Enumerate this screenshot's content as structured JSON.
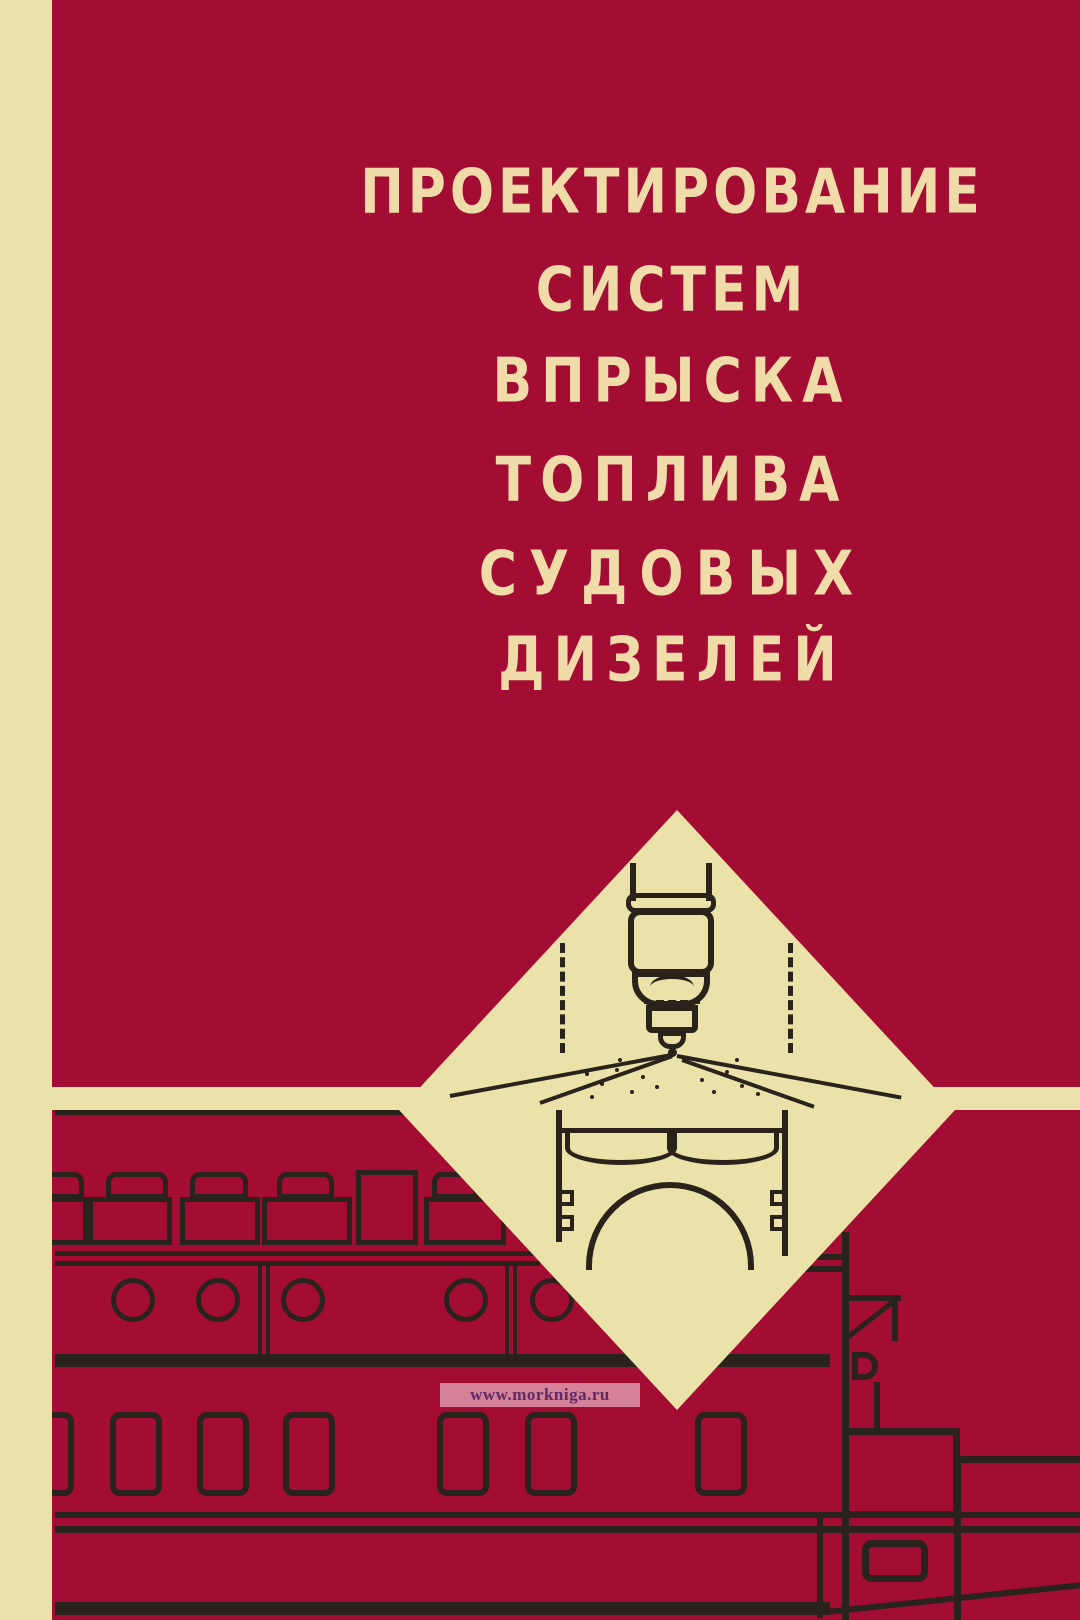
{
  "cover": {
    "title_lines": [
      "ПРОЕКТИРОВАНИЕ",
      "СИСТЕМ",
      "ВПРЫСКА",
      "ТОПЛИВА",
      "СУДОВЫХ",
      "ДИЗЕЛЕЙ"
    ],
    "watermark_text": "www.morkniga.ru"
  },
  "colors": {
    "red": "#A30D33",
    "cream": "#EBE2AA",
    "ink": "#29231B",
    "title": "#EFDCA9",
    "wm_text": "#5E2A66"
  },
  "illustrations": {
    "diamond_panel": "diamond-panel",
    "injector": "fuel-injector-nozzle-diagram",
    "chamber": "piston-combustion-chamber-diagram",
    "engine": "marine-diesel-engine-line-drawing",
    "ship": "ship-superstructure-line-drawing"
  }
}
